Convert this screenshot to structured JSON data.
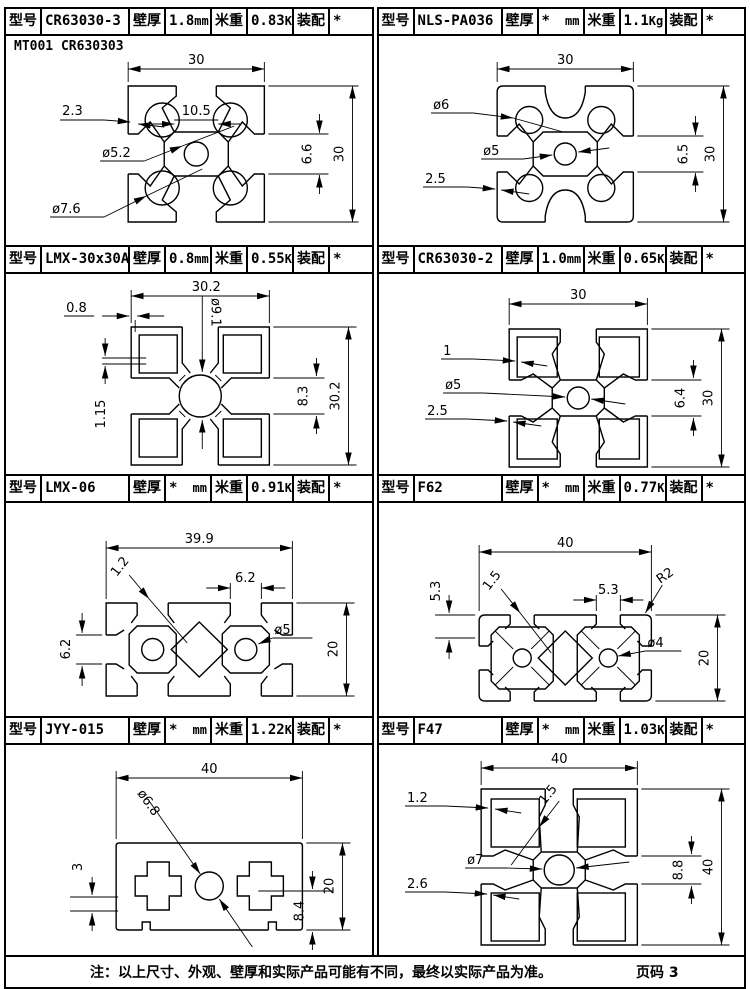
{
  "labels": {
    "model": "型号",
    "wall": "壁厚",
    "wall_unit": "mm",
    "weight": "米重",
    "weight_unit": "Kg",
    "assembly": "装配"
  },
  "footer": {
    "note": "注：以上尺寸、外观、壁厚和实际产品可能有不同，最终以实际产品为准。",
    "page": "页码 3"
  },
  "cells": [
    {
      "model": "CR63030-3",
      "wall": "1.8",
      "weight": "0.83",
      "assembly": "*",
      "corner_note": "MT001 CR630303",
      "dims": {
        "width": "30",
        "height": "30",
        "wall": "2.3",
        "slot": "10.5",
        "center_hole": "ø5.2",
        "corner_hole": "ø7.6",
        "slot_height": "6.6"
      }
    },
    {
      "model": "NLS-PA036",
      "wall": "*",
      "weight": "1.1",
      "assembly": "*",
      "dims": {
        "width": "30",
        "height": "30",
        "corner_hole": "ø6",
        "center_hole": "ø5",
        "wall": "2.5",
        "slot_height": "6.5"
      }
    },
    {
      "model": "LMX-30x30A",
      "wall": "0.8",
      "weight": "0.55",
      "assembly": "*",
      "dims": {
        "width": "30.2",
        "height": "30.2",
        "wall": "0.8",
        "center_hole": "ø9.1",
        "step": "1.15",
        "slot_height": "8.3"
      }
    },
    {
      "model": "CR63030-2",
      "wall": "1.0",
      "weight": "0.65",
      "assembly": "*",
      "dims": {
        "width": "30",
        "height": "30",
        "wall": "1",
        "center_hole": "ø5",
        "wall2": "2.5",
        "slot_height": "6.4"
      }
    },
    {
      "model": "LMX-06",
      "wall": "*",
      "weight": "0.91",
      "assembly": "*",
      "dims": {
        "width": "39.9",
        "height": "20",
        "wall": "1.2",
        "slot_top": "6.2",
        "slot_side": "6.2",
        "center_hole": "ø5"
      }
    },
    {
      "model": "F62",
      "wall": "*",
      "weight": "0.77",
      "assembly": "*",
      "dims": {
        "width": "40",
        "height": "20",
        "side": "5.3",
        "wall": "1.5",
        "slot_top": "5.3",
        "radius": "R2",
        "center_hole": "ø4"
      }
    },
    {
      "model": "JYY-015",
      "wall": "*",
      "weight": "1.22",
      "assembly": "*",
      "dims": {
        "width": "40",
        "height": "20",
        "center_hole": "ø6.8",
        "step": "3",
        "slot_height": "8.4"
      }
    },
    {
      "model": "F47",
      "wall": "*",
      "weight": "1.03",
      "assembly": "*",
      "dims": {
        "width": "40",
        "height": "40",
        "wall": "1.2",
        "web": "1.5",
        "center_hole": "ø7",
        "wall2": "2.6",
        "slot_height": "8.8"
      }
    }
  ]
}
